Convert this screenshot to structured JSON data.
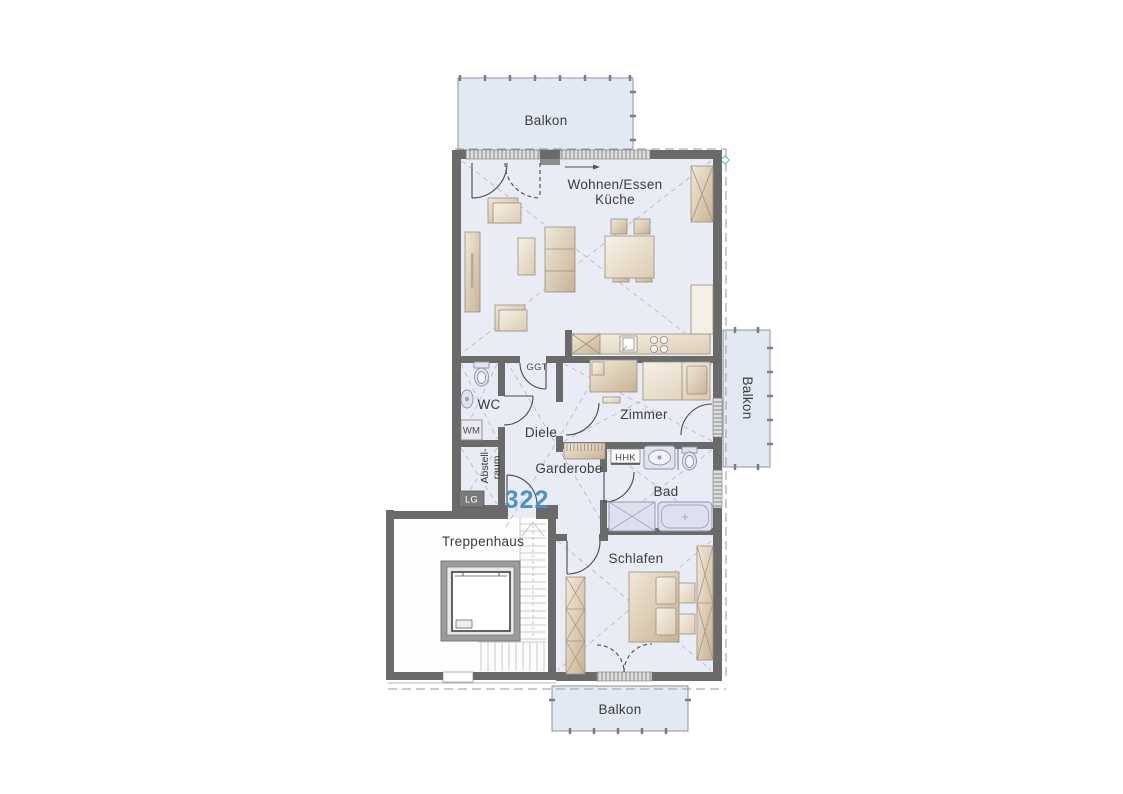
{
  "plan": {
    "unit_number": "322",
    "rooms": {
      "balkon_top": "Balkon",
      "wohnen_line1": "Wohnen/Essen",
      "wohnen_line2": "Küche",
      "wc": "WC",
      "diele": "Diele",
      "zimmer": "Zimmer",
      "garderobe": "Garderobe",
      "bad": "Bad",
      "schlafen": "Schlafen",
      "treppenhaus": "Treppenhaus",
      "abstell_line1": "Abstell-",
      "abstell_line2": "raum.",
      "balkon_right": "Balkon",
      "balkon_bottom": "Balkon"
    },
    "annotations": {
      "ggt": "GGT",
      "wm": "WM",
      "hhk": "HHK",
      "lg": "LG"
    },
    "colors": {
      "floor": "#e9ecf5",
      "balcony_floor": "#e3e9f3",
      "wall": "#6a6a6a",
      "furniture_beige": "#d9c5a8",
      "fixture_lavender": "#e2e2f0",
      "unit_number_blue": "#4e8fc4",
      "label_text": "#3c3c3c",
      "dashed_guides": "#b6bcca"
    }
  }
}
